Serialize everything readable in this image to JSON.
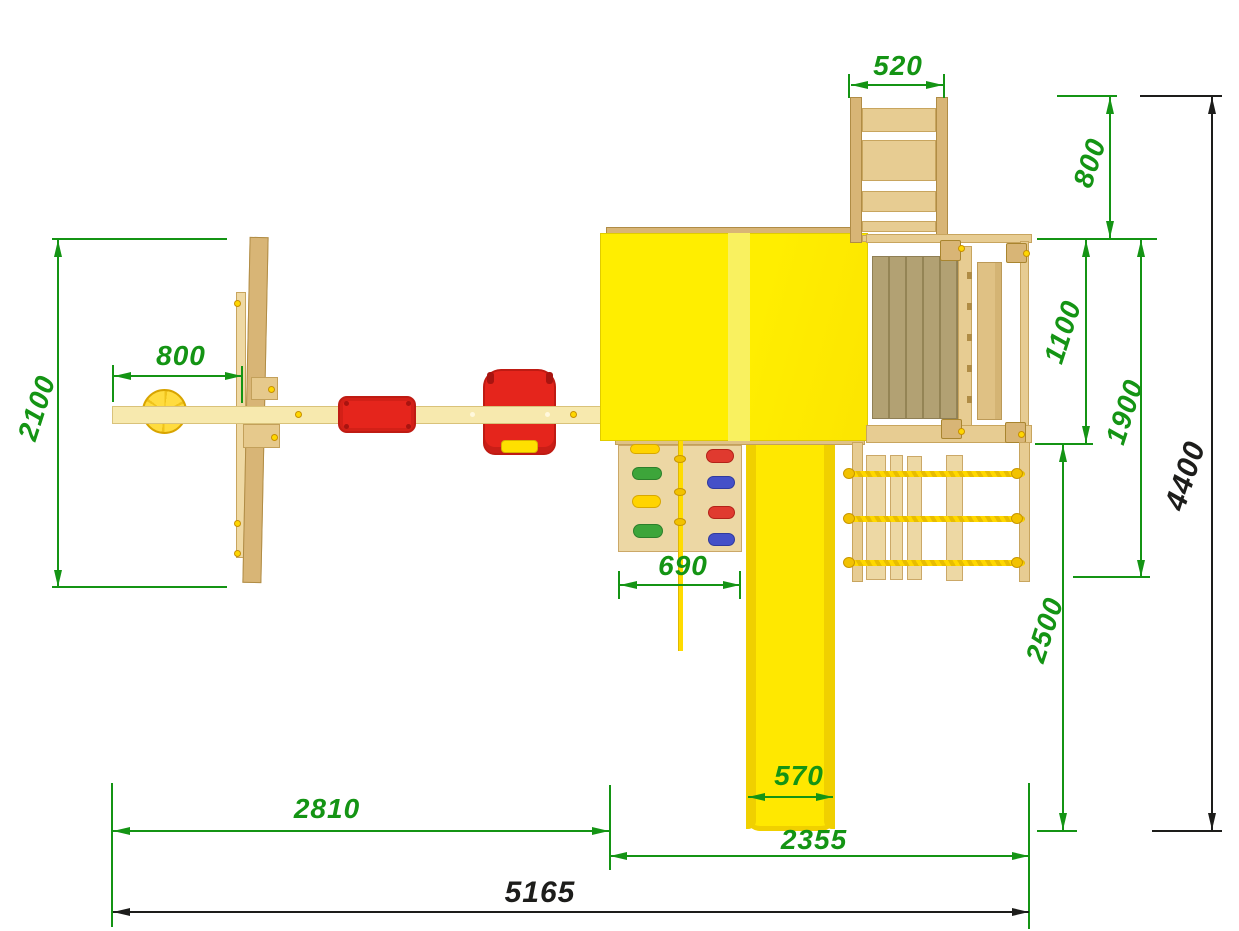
{
  "title": "Playground set — top view dimensional drawing",
  "units_note": "",
  "colors": {
    "dimension_green": "#149414",
    "dimension_black": "#1d1d1b",
    "roof_yellow": "#ffec00",
    "roof_ridge_yellow": "#f9f160",
    "slide_yellow": "#ffe800",
    "seat_red": "#e5251c",
    "disc_swing_yellow": "#ffd92e",
    "rope_yellow": "#ffd800",
    "wood_light": "#f7e9ae",
    "wood_tan": "#e7cc92",
    "wood_dark": "#d8b576",
    "deck_olive": "#b2a173",
    "hold_yellow": "#ffd400",
    "hold_green": "#3da53a",
    "hold_red": "#e03a2f",
    "hold_blue": "#4450c8"
  },
  "dimensions": {
    "ladder_width": {
      "value": "520",
      "color": "green"
    },
    "ladder_extension_depth": {
      "value": "800",
      "color": "green"
    },
    "platform_depth": {
      "value": "1100",
      "color": "green"
    },
    "platform_total_depth": {
      "value": "1900",
      "color": "green"
    },
    "overall_depth": {
      "value": "4400",
      "color": "black"
    },
    "swing_frame_depth": {
      "value": "2100",
      "color": "green"
    },
    "swing_offset": {
      "value": "800",
      "color": "green"
    },
    "climbing_wall_width": {
      "value": "690",
      "color": "green"
    },
    "slide_run_depth": {
      "value": "2500",
      "color": "green"
    },
    "slide_width": {
      "value": "570",
      "color": "green"
    },
    "swing_section_length": {
      "value": "2810",
      "color": "green"
    },
    "tower_section_length": {
      "value": "2355",
      "color": "green"
    },
    "overall_length": {
      "value": "5165",
      "color": "black"
    }
  }
}
